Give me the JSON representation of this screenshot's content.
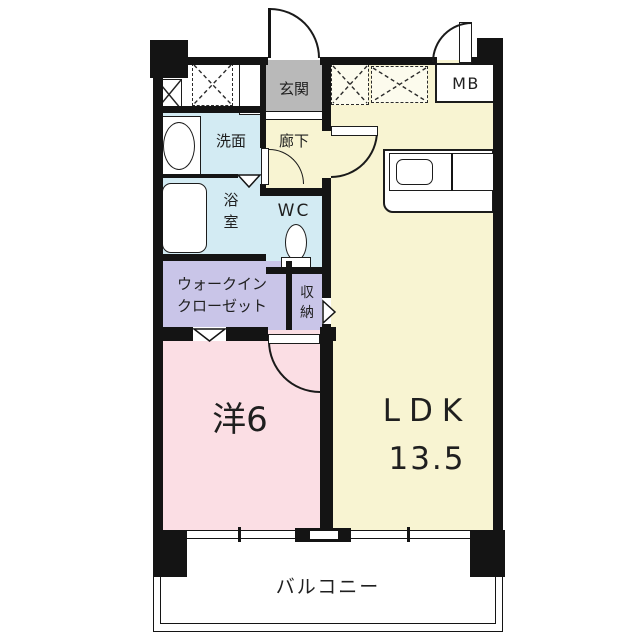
{
  "floorplan": {
    "rooms": {
      "genkan": {
        "label": "玄関"
      },
      "rouka": {
        "label": "廊下"
      },
      "senmen": {
        "label": "洗面"
      },
      "yokushitsu": {
        "line1": "浴",
        "line2": "室"
      },
      "wc": {
        "label": "WC"
      },
      "wic": {
        "line1": "ウォークイン",
        "line2": "クローゼット"
      },
      "shuno": {
        "line1": "収",
        "line2": "納"
      },
      "western6": {
        "label": "洋6"
      },
      "ldk": {
        "label": "LDK",
        "size": "13.5"
      },
      "mb": {
        "label": "MB"
      },
      "balcony": {
        "label": "バルコニー"
      }
    },
    "colors": {
      "wall": "#141414",
      "ldk_yellow": "#f8f4d2",
      "room_pink": "#fbdee4",
      "wet_blue": "#d3ebf3",
      "closet_lavender": "#c9c5e8",
      "entrance_gray": "#b9b9b9",
      "text": "#1f1f1f"
    }
  }
}
